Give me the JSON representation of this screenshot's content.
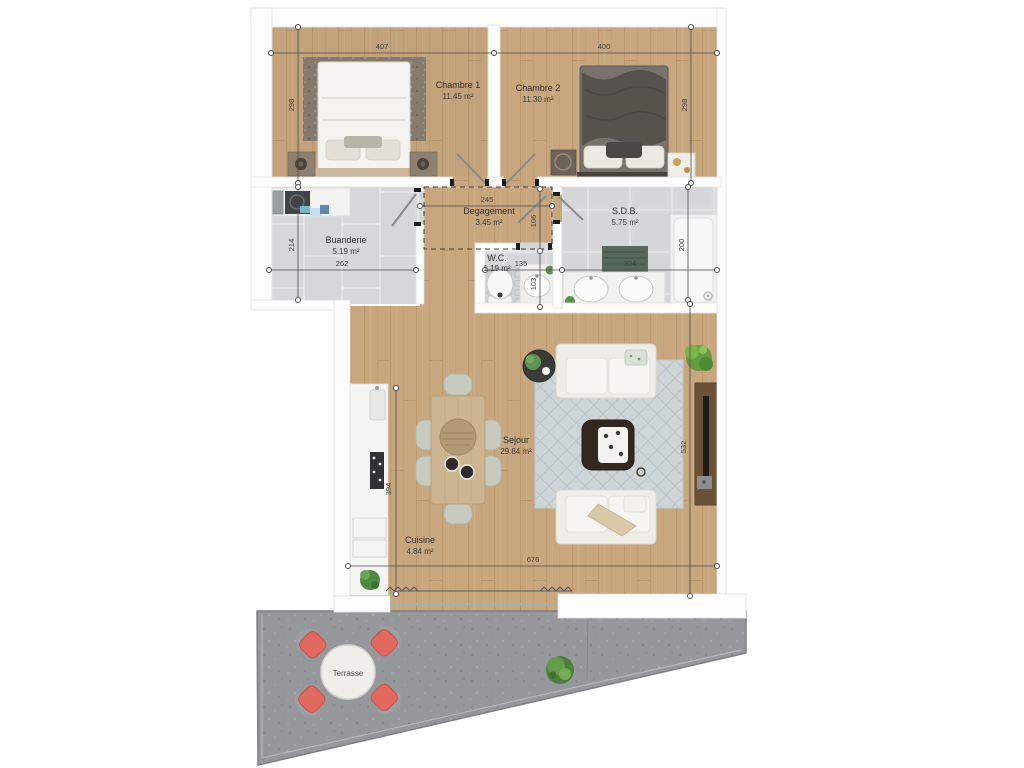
{
  "plan_title": "Apartment floor plan",
  "rooms": {
    "chambre1": {
      "name": "Chambre 1",
      "area": "11.45 m²"
    },
    "chambre2": {
      "name": "Chambre 2",
      "area": "11.30 m²"
    },
    "buanderie": {
      "name": "Buanderie",
      "area": "5.19 m²"
    },
    "degagement": {
      "name": "Degagement",
      "area": "3.45 m²"
    },
    "wc": {
      "name": "W.C.",
      "area": "1.19 m²"
    },
    "sdb": {
      "name": "S.D.B.",
      "area": "5.75 m²"
    },
    "sejour": {
      "name": "Sejour",
      "area": "29.84 m²"
    },
    "cuisine": {
      "name": "Cuisine",
      "area": "4.84 m²"
    },
    "terrasse": {
      "name": "Terrasse"
    }
  },
  "dimensions_cm": {
    "chambre1_width": "407",
    "chambre2_width": "400",
    "chambre1_depth": "298",
    "chambre2_depth": "298",
    "degagement_width": "245",
    "degagement_depth": "106",
    "buanderie_width": "262",
    "buanderie_depth": "214",
    "wc_width": "135",
    "wc_depth": "103",
    "sdb_width": "304",
    "sdb_depth": "200",
    "sejour_width": "676",
    "sejour_depth": "532",
    "cuisine_depth": "394"
  },
  "colors": {
    "wood": "#c8a77f",
    "tile": "#d7d8da",
    "terrace_gray": "#96989c",
    "wall_white": "#fdfdfd",
    "dimension_line": "#454545",
    "terrace_chair": "#e2695f",
    "plant_green": "#5f9349"
  }
}
